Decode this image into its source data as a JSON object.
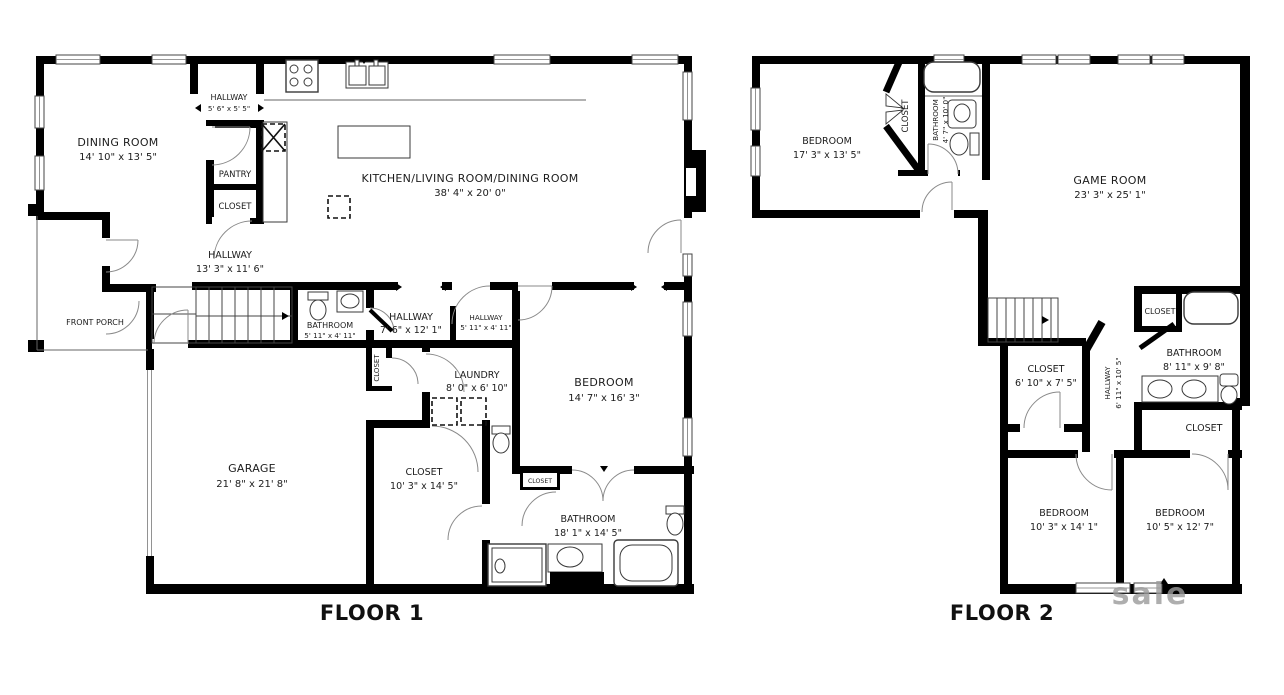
{
  "floor1": {
    "label": "FLOOR 1",
    "rooms": {
      "dining": {
        "name": "DINING ROOM",
        "dims": "14' 10\" x 13' 5\""
      },
      "hallway_top": {
        "name": "HALLWAY",
        "dims": "5' 6\" x 5' 5\""
      },
      "pantry": {
        "name": "PANTRY"
      },
      "pantry_closet": {
        "name": "CLOSET"
      },
      "kitchen": {
        "name": "KITCHEN/LIVING ROOM/DINING ROOM",
        "dims": "38' 4\" x 20' 0\""
      },
      "hallway_main": {
        "name": "HALLWAY",
        "dims": "13' 3\" x 11' 6\""
      },
      "front_porch": {
        "name": "FRONT PORCH"
      },
      "bathroom_small": {
        "name": "BATHROOM",
        "dims": "5' 11\" x 4' 11\""
      },
      "hallway_mid": {
        "name": "HALLWAY",
        "dims": "7' 6\" x 12' 1\""
      },
      "hallway_small": {
        "name": "HALLWAY",
        "dims": "5' 11\" x 4' 11\""
      },
      "hall_closet": {
        "name": "CLOSET"
      },
      "laundry": {
        "name": "LAUNDRY",
        "dims": "8' 0\" x 6' 10\""
      },
      "garage": {
        "name": "GARAGE",
        "dims": "21' 8\" x 21' 8\""
      },
      "closet_master": {
        "name": "CLOSET",
        "dims": "10' 3\" x 14' 5\""
      },
      "bedroom": {
        "name": "BEDROOM",
        "dims": "14' 7\" x 16' 3\""
      },
      "closet_small": {
        "name": "CLOSET"
      },
      "bathroom_master": {
        "name": "BATHROOM",
        "dims": "18' 1\" x 14' 5\""
      }
    }
  },
  "floor2": {
    "label": "FLOOR 2",
    "rooms": {
      "bedroom1": {
        "name": "BEDROOM",
        "dims": "17' 3\" x 13' 5\""
      },
      "closet_bedroom1": {
        "name": "CLOSET"
      },
      "bathroom1": {
        "name": "BATHROOM",
        "dims": "4' 7\" x 10' 0\""
      },
      "gameroom": {
        "name": "GAME ROOM",
        "dims": "23' 3\" x 25' 1\""
      },
      "closet_hall": {
        "name": "CLOSET",
        "dims": "6' 10\" x 7' 5\""
      },
      "hallway": {
        "name": "HALLWAY",
        "dims": "6' 11\" x 10' 5\""
      },
      "bathroom2": {
        "name": "BATHROOM",
        "dims": "8' 11\" x 9' 8\""
      },
      "closet_bath": {
        "name": "CLOSET"
      },
      "closet_right": {
        "name": "CLOSET"
      },
      "bedroom2": {
        "name": "BEDROOM",
        "dims": "10' 3\" x 14' 1\""
      },
      "bedroom3": {
        "name": "BEDROOM",
        "dims": "10' 5\" x 12' 7\""
      }
    }
  },
  "watermark": "sale",
  "colors": {
    "wall": "#000000",
    "background": "#ffffff",
    "text": "#1c1c1c"
  }
}
